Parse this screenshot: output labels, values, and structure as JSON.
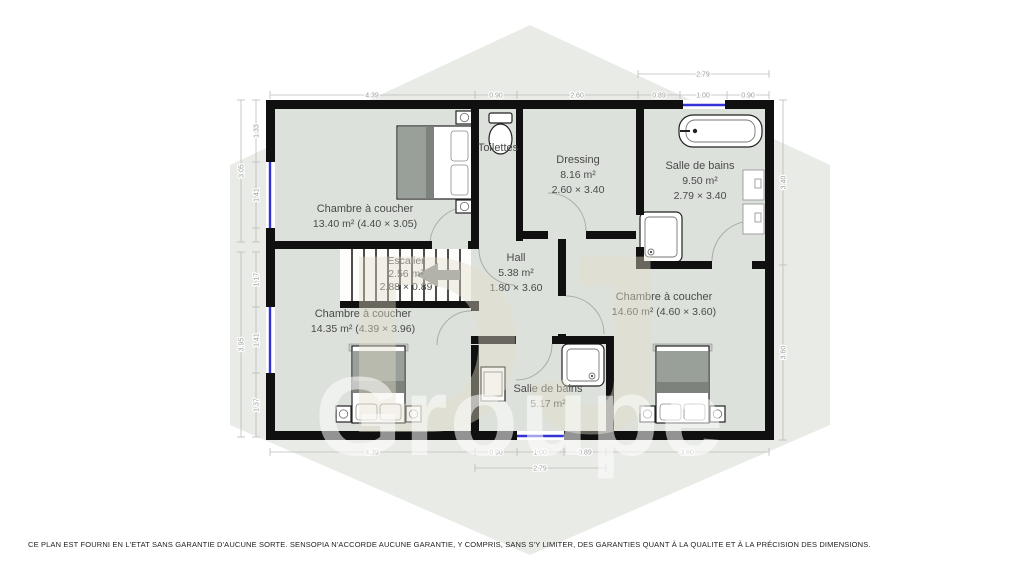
{
  "rooms": {
    "bedroom1": {
      "name": "Chambre à coucher",
      "area": "13.40 m² (4.40 × 3.05)"
    },
    "toilettes": {
      "name": "Toilettes"
    },
    "dressing": {
      "name": "Dressing",
      "area": "8.16 m²",
      "size": "2.60 × 3.40"
    },
    "bathroom1": {
      "name": "Salle de bains",
      "area": "9.50 m²",
      "size": "2.79 × 3.40"
    },
    "stairs": {
      "name": "Escalier",
      "area": "2.56 m²",
      "size": "2.88 × 0.89"
    },
    "hall": {
      "name": "Hall",
      "area": "5.38 m²",
      "size": "1.80 × 3.60"
    },
    "bedroom2": {
      "name": "Chambre à coucher",
      "area": "14.35 m² (4.39 × 3.96)"
    },
    "bathroom2": {
      "name": "Salle de bains",
      "area": "5.17 m²"
    },
    "bedroom3": {
      "name": "Chambre à coucher",
      "area": "14.60 m² (4.60 × 3.60)"
    }
  },
  "dims": {
    "top": [
      "4.39",
      "0.90",
      "2.60",
      "0.89",
      "1.00",
      "0.90"
    ],
    "top_overall": "2.79",
    "bottom": [
      "4.39",
      "0.90",
      "1.00",
      "0.89",
      "3.60"
    ],
    "bottom_overall": "2.79",
    "left_upper": [
      "1.33",
      "1.41"
    ],
    "left_upper_overall": "3.05",
    "left_lower": [
      "1.17",
      "1.41",
      "1.37"
    ],
    "left_lower_overall": "3.95",
    "right": [
      "3.40",
      "3.60"
    ]
  },
  "watermark": {
    "line1": "DJ",
    "line2": "Groupe"
  },
  "colors": {
    "wall": "#101010",
    "floor": "#dce1db",
    "window": "#3434d6",
    "watermark_hex": "#e9ece6"
  },
  "footer": {
    "disclaimer": "CE PLAN EST FOURNI EN L'ETAT SANS GARANTIE D'AUCUNE SORTE. SENSOPIA N'ACCORDE AUCUNE GARANTIE, Y COMPRIS, SANS S'Y LIMITER, DES GARANTIES QUANT À LA QUALITE ET À LA PRÉCISION DES DIMENSIONS."
  }
}
